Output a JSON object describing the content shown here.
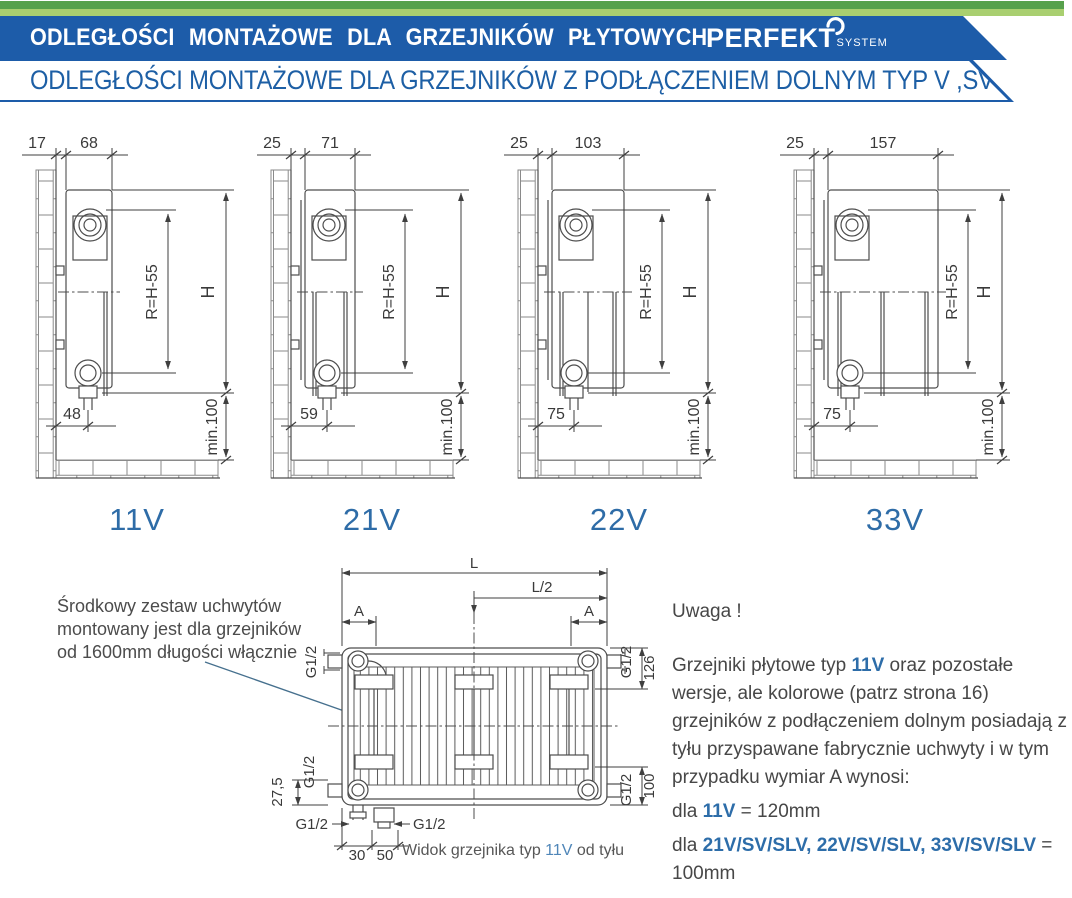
{
  "header": {
    "bar1_text": "ODLEGŁOŚCI MONTAŻOWE DLA GRZEJNIKÓW PŁYTOWYCH",
    "logo_main": "PERFEKT",
    "logo_sub": "SYSTEM",
    "bar2_text": "ODLEGŁOŚCI MONTAŻOWE DLA GRZEJNIKÓW Z PODŁĄCZENIEM DOLNYM TYP V ,SV ,SLV",
    "colors": {
      "banner_blue": "#1d5ca9",
      "text_blue": "#1d5fa5",
      "green_dark": "#57a14c",
      "green_light": "#a9cf70",
      "label_blue": "#2e6ca7",
      "highlight_blue": "#2d6da9"
    }
  },
  "diagrams": [
    {
      "type_label": "11V",
      "wall_gap": "17",
      "depth": "68",
      "radius_dim": "R=H-55",
      "height_dim": "H",
      "bottom_offset": "48",
      "min_clearance": "min.100"
    },
    {
      "type_label": "21V",
      "wall_gap": "25",
      "depth": "71",
      "radius_dim": "R=H-55",
      "height_dim": "H",
      "bottom_offset": "59",
      "min_clearance": "min.100"
    },
    {
      "type_label": "22V",
      "wall_gap": "25",
      "depth": "103",
      "radius_dim": "R=H-55",
      "height_dim": "H",
      "bottom_offset": "75",
      "min_clearance": "min.100"
    },
    {
      "type_label": "33V",
      "wall_gap": "25",
      "depth": "157",
      "radius_dim": "R=H-55",
      "height_dim": "H",
      "bottom_offset": "75",
      "min_clearance": "min.100"
    }
  ],
  "middle_note": {
    "line1": "Środkowy zestaw uchwytów",
    "line2": "montowany jest dla grzejników",
    "line3": "od 1600mm długości włącznie"
  },
  "rear": {
    "l": "L",
    "l_half": "L/2",
    "a": "A",
    "g_thread": "G1/2",
    "bracket_top": "126",
    "bracket_bottom": "100",
    "offset_bottom": "27,5",
    "pipe_offset_1": "30",
    "pipe_offset_2": "50",
    "caption_pre": "Widok grzejnika typ ",
    "caption_hl": "11V",
    "caption_post": " od tyłu"
  },
  "note": {
    "title": "Uwaga !",
    "p1_pre": "Grzejniki płytowe typ ",
    "p1_hl": "11V",
    "p1_post": " oraz pozostałe wersje, ale kolorowe (patrz strona 16) grzejników z podłączeniem dolnym posiadają z tyłu przyspawane fabrycznie uchwyty i w tym przypadku wymiar A wynosi:",
    "l2_pre": "dla ",
    "l2_hl": "11V",
    "l2_post": " = 120mm",
    "l3_pre": "dla ",
    "l3_hl": "21V/SV/SLV, 22V/SV/SLV, 33V/SV/SLV",
    "l3_post": " = 100mm"
  }
}
